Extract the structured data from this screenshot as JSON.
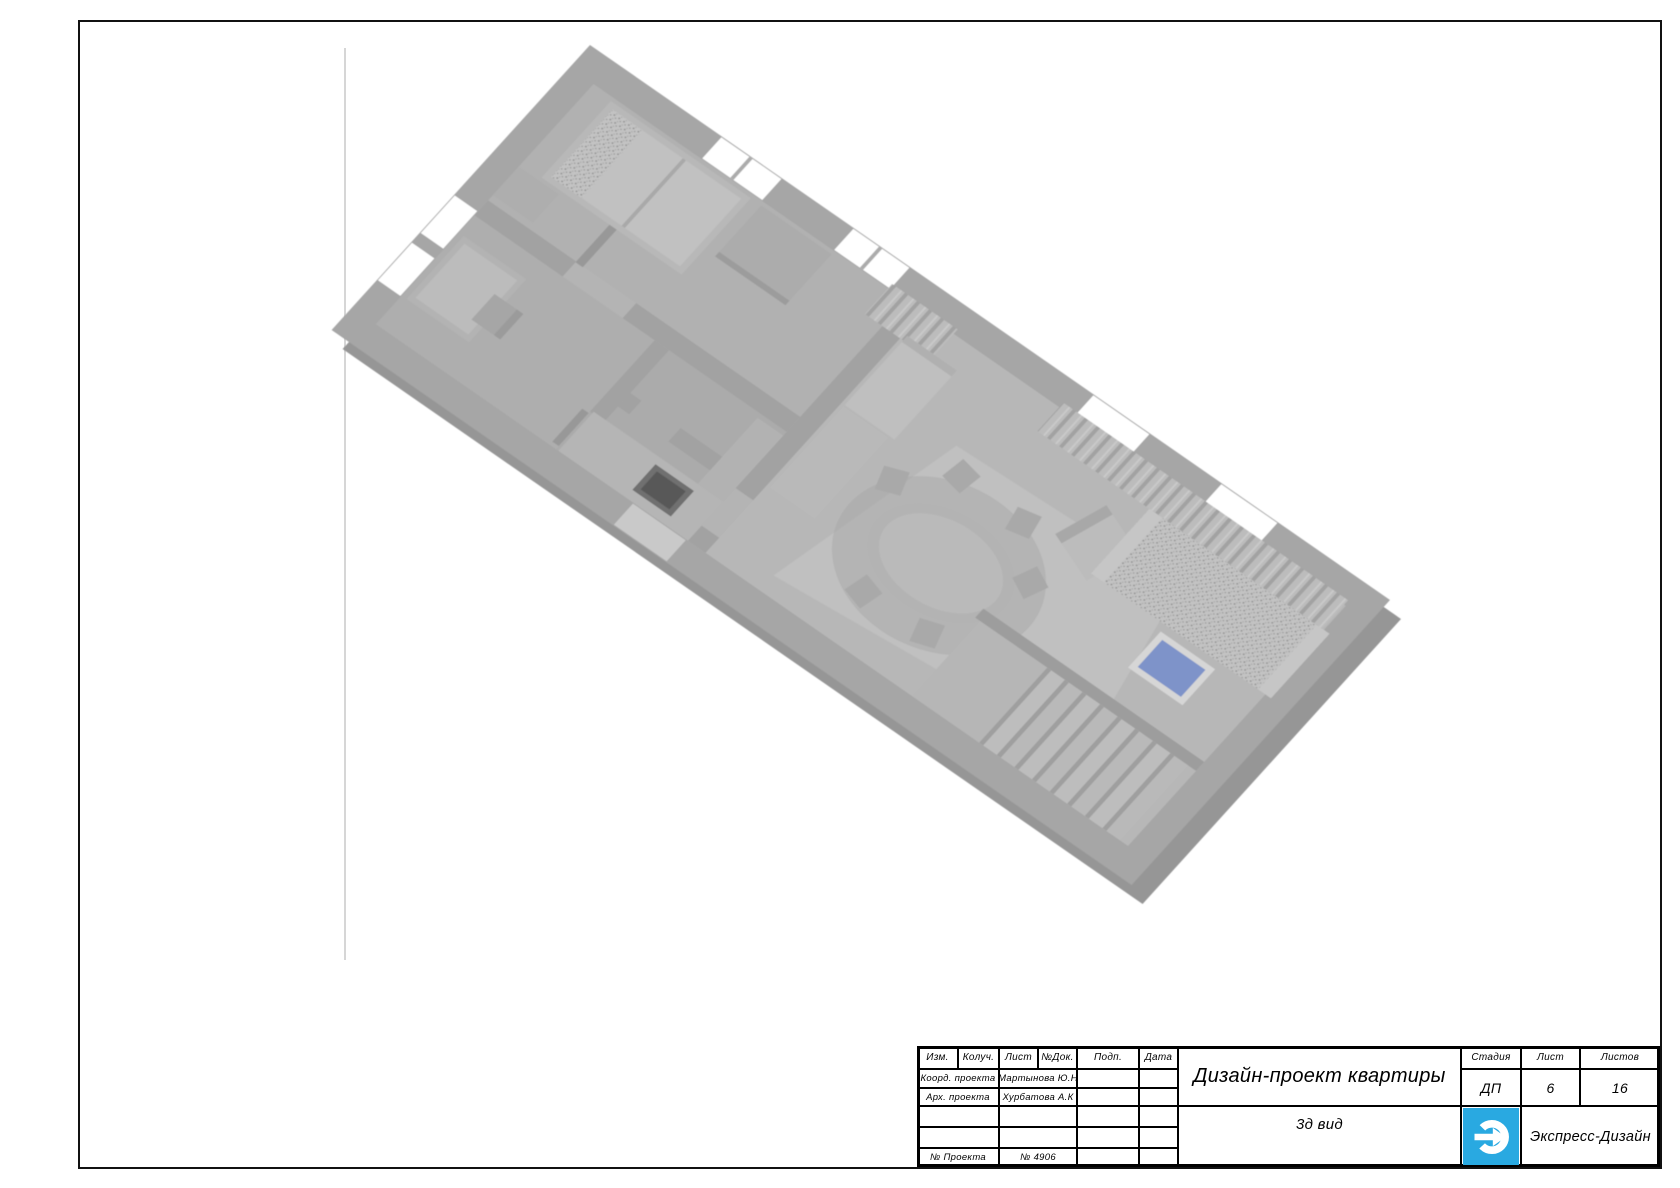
{
  "sheet": {
    "kind": "design project drawing sheet",
    "border_color": "#111111",
    "background": "#ffffff"
  },
  "render_3d": {
    "description": "monochrome 3d axonometric view of apartment",
    "wall_color": "#a6a6a6",
    "floor_color": "#b4b4b4",
    "coffee_table_top_color": "#7e93c9"
  },
  "titleblock": {
    "header_cols": [
      "Изм.",
      "Колуч.",
      "Лист",
      "№Док.",
      "Подп.",
      "Дата"
    ],
    "rows": [
      {
        "label": "Коорд. проекта",
        "value": "Мартынова Ю.Н"
      },
      {
        "label": "Арх. проекта",
        "value": "Хурбатова А.К"
      },
      {
        "label": "",
        "value": ""
      },
      {
        "label": "",
        "value": ""
      },
      {
        "label": "№ Проекта",
        "value": "№ 4906"
      }
    ],
    "project_title": "Дизайн-проект квартиры",
    "view_label": "3д вид",
    "stage_label": "Стадия",
    "stage_value": "ДП",
    "sheet_label": "Лист",
    "sheet_value": "6",
    "sheets_label": "Листов",
    "sheets_value": "16",
    "company": "Экспресс-Дизайн",
    "logo_color": "#29a9e1"
  }
}
